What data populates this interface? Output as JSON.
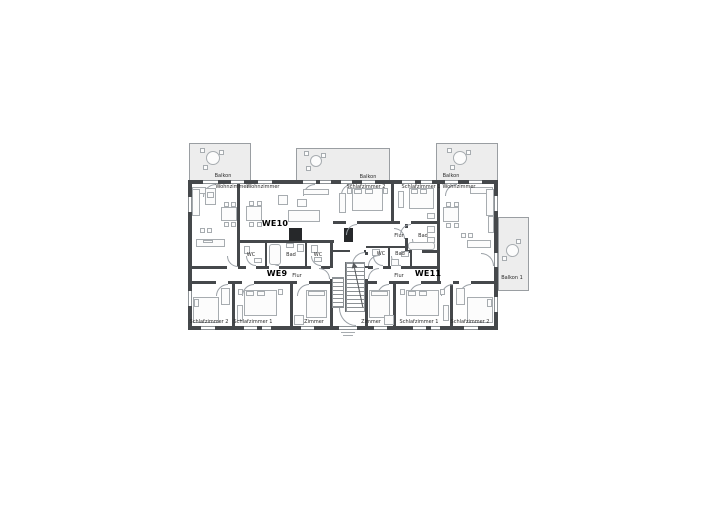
{
  "floorplan": {
    "units": [
      "WE9",
      "WE10",
      "WE11"
    ],
    "rooms": [
      {
        "label": "Balkon"
      },
      {
        "label": "Wohnzimmer"
      },
      {
        "label": "Wohnzimmer"
      },
      {
        "label": "Balkon"
      },
      {
        "label": "Schlafzimmer 2"
      },
      {
        "label": "Schlafzimmer 1"
      },
      {
        "label": "Balkon"
      },
      {
        "label": "Wohnzimmer"
      },
      {
        "label": "WE10"
      },
      {
        "label": "WC"
      },
      {
        "label": "Bad"
      },
      {
        "label": "WC"
      },
      {
        "label": "Flur"
      },
      {
        "label": "Bad"
      },
      {
        "label": "WC"
      },
      {
        "label": "Bad"
      },
      {
        "label": "WE9"
      },
      {
        "label": "Flur"
      },
      {
        "label": "Flur"
      },
      {
        "label": "WE11"
      },
      {
        "label": "Balkon 1"
      },
      {
        "label": "Schlafzimmer 2"
      },
      {
        "label": "Schlafzimmer 1"
      },
      {
        "label": "Zimmer"
      },
      {
        "label": "Zimmer"
      },
      {
        "label": "Schlafzimmer 1"
      },
      {
        "label": "Schlafzimmer 2"
      }
    ],
    "colors": {
      "wall": "#45484b",
      "furniture_line": "#a7acb0",
      "balcony_fill": "#ededed",
      "text": "#2b2b2b"
    }
  }
}
